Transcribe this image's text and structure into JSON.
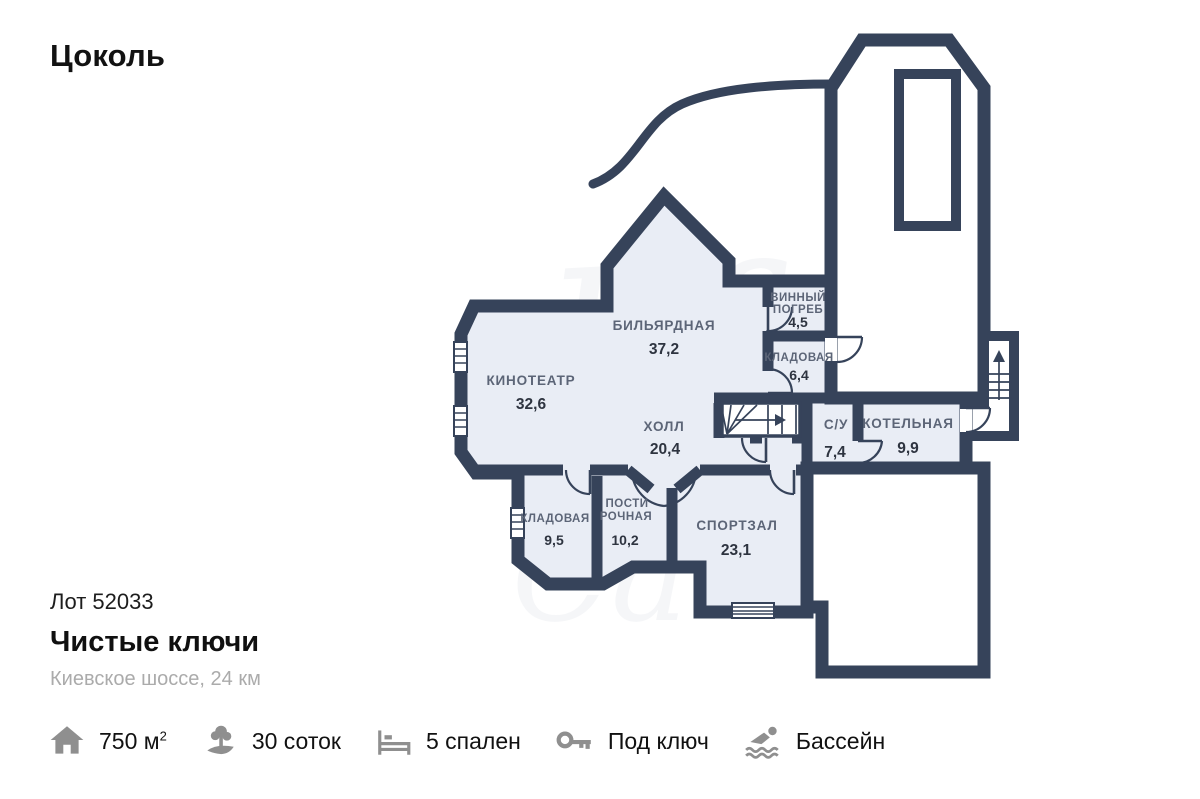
{
  "page": {
    "title": "Цоколь"
  },
  "listing": {
    "lot": "Лот 52033",
    "name": "Чистые ключи",
    "location": "Киевское шоссе, 24 км"
  },
  "rooms": [
    {
      "name": "КИНОТЕАТР",
      "area": "32,6"
    },
    {
      "name": "БИЛЬЯРДНАЯ",
      "area": "37,2"
    },
    {
      "name": "ХОЛЛ",
      "area": "20,4"
    },
    {
      "name": "ВИННЫЙ ПОГРЕБ",
      "l1": "ВИННЫЙ",
      "l2": "ПОГРЕБ",
      "area": "4,5"
    },
    {
      "name": "КЛАДОВАЯ",
      "area": "6,4"
    },
    {
      "name": "С/У",
      "area": "7,4"
    },
    {
      "name": "КОТЕЛЬНАЯ",
      "area": "9,9"
    },
    {
      "name": "КЛАДОВАЯ",
      "area": "9,5"
    },
    {
      "name": "ПОСТИРОЧНАЯ",
      "l1": "ПОСТИ",
      "l2": "РОЧНАЯ",
      "area": "10,2"
    },
    {
      "name": "СПОРТЗАЛ",
      "area": "23,1"
    }
  ],
  "features": [
    {
      "icon": "house-icon",
      "label": "750 м",
      "sup": "2"
    },
    {
      "icon": "land-icon",
      "label": "30 соток"
    },
    {
      "icon": "bed-icon",
      "label": "5 спален"
    },
    {
      "icon": "key-icon",
      "label": "Под ключ"
    },
    {
      "icon": "pool-icon",
      "label": "Бассейн"
    }
  ],
  "watermark": {
    "text1": "life",
    "text2": "Ca"
  },
  "colors": {
    "wall": "#36435A",
    "room_fill": "#E9EDF5",
    "label": "#5C6577",
    "number": "#2E3440",
    "icon_gray": "#8F8F8F",
    "watermark": "rgba(60,82,125,0.05)"
  }
}
